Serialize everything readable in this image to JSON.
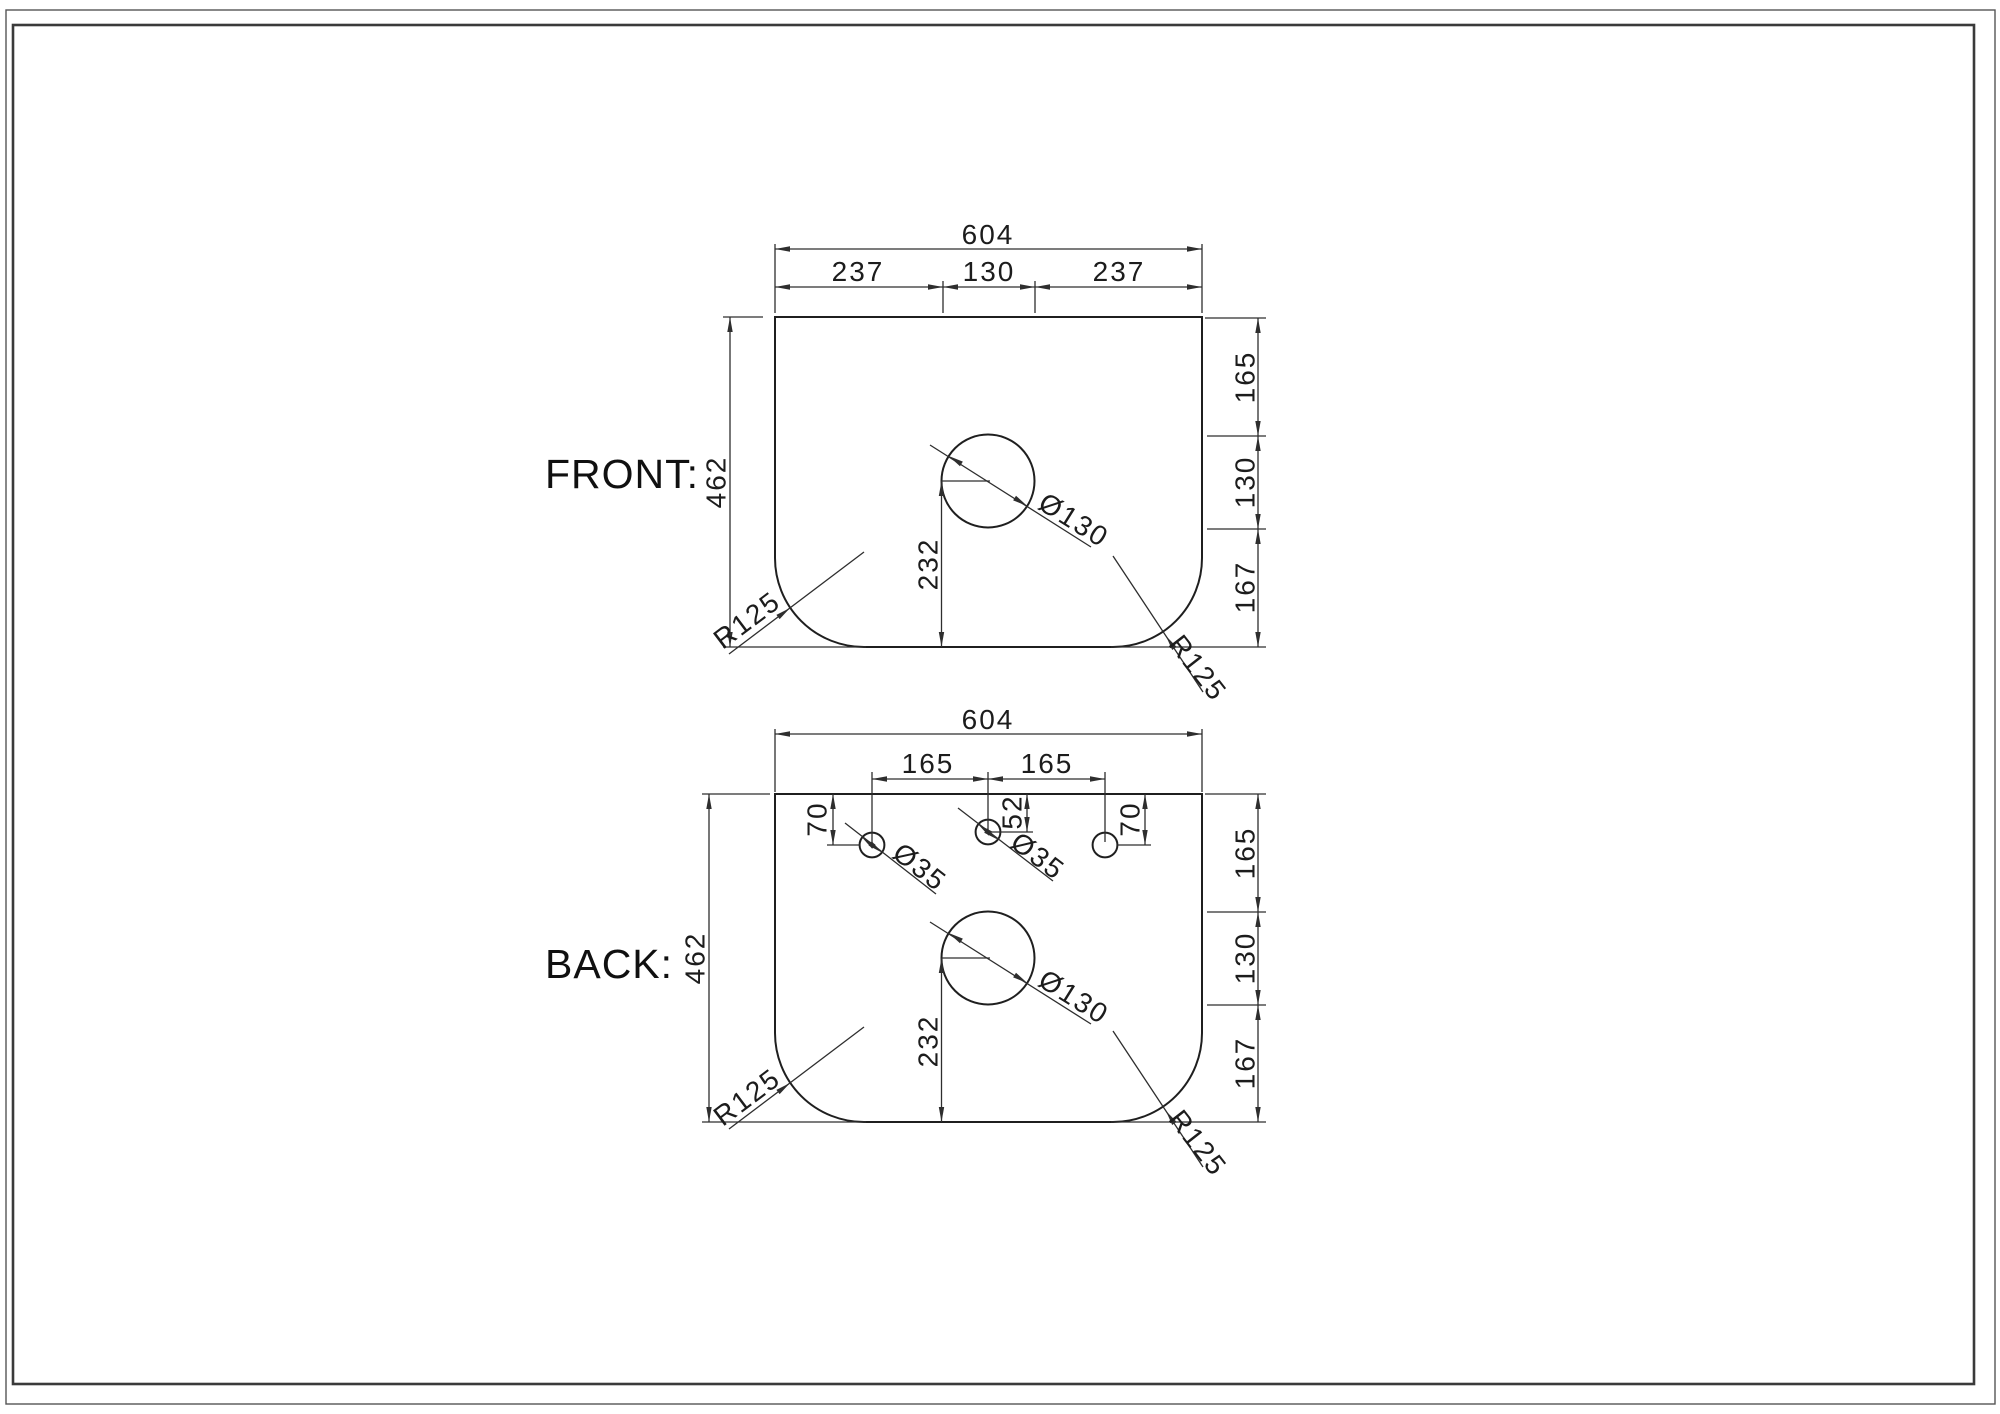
{
  "drawing": {
    "front": {
      "label": "FRONT:",
      "total_width": "604",
      "seg_left": "237",
      "seg_mid": "130",
      "seg_right": "237",
      "total_height": "462",
      "right_top": "165",
      "right_mid": "130",
      "right_bot": "167",
      "center_height": "232",
      "hole_dia": "Ø130",
      "radius_bl": "R125",
      "radius_br": "R125"
    },
    "back": {
      "label": "BACK:",
      "total_width": "604",
      "spacing_left": "165",
      "spacing_right": "165",
      "total_height": "462",
      "right_top": "165",
      "right_mid": "130",
      "right_bot": "167",
      "center_height": "232",
      "hole_dia": "Ø130",
      "small_dia_left": "Ø35",
      "small_dia_mid": "Ø35",
      "offset_left": "70",
      "offset_mid": "52",
      "offset_right": "70",
      "radius_bl": "R125",
      "radius_br": "R125"
    }
  }
}
